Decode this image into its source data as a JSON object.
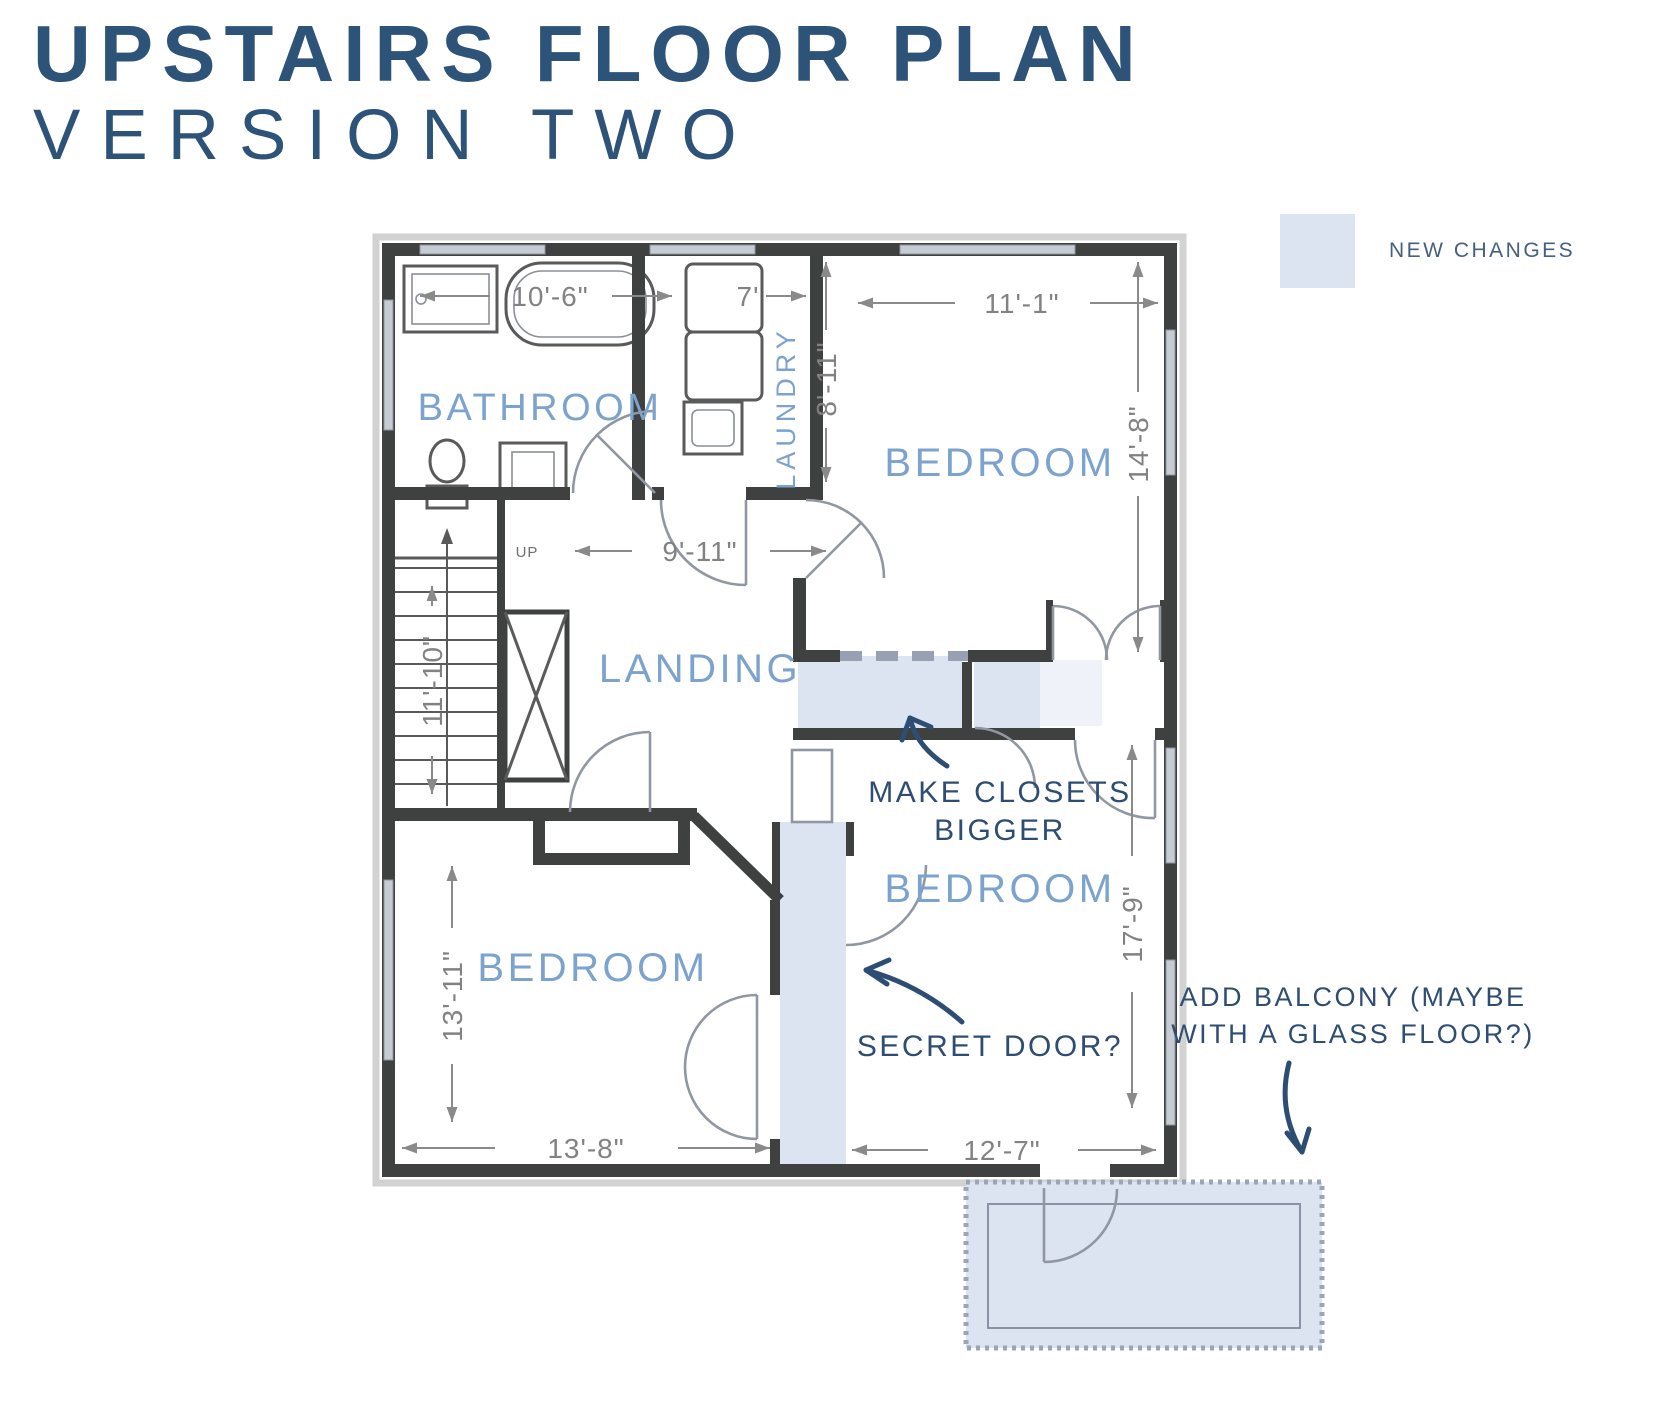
{
  "title": {
    "line1": "UPSTAIRS FLOOR PLAN",
    "line2": "VERSION TWO"
  },
  "legend": {
    "label": "NEW CHANGES",
    "swatch_color": "#dce3f1"
  },
  "rooms": {
    "bathroom": "BATHROOM",
    "laundry": "LAUNDRY",
    "bedroom_top_right": "BEDROOM",
    "landing": "LANDING",
    "bedroom_bottom_left": "BEDROOM",
    "bedroom_bottom_right": "BEDROOM"
  },
  "stairs": {
    "direction_label": "UP"
  },
  "dimensions": {
    "bathroom_width": "10'-6\"",
    "laundry_width": "7'",
    "laundry_depth": "8'-11\"",
    "bedroom_top_right_width": "11'-1\"",
    "bedroom_top_right_depth": "14'-8\"",
    "landing_width": "9'-11\"",
    "stairwell_depth": "11'-10\"",
    "bedroom_bottom_left_depth": "13'-11\"",
    "bedroom_bottom_left_width": "13'-8\"",
    "bedroom_bottom_right_depth": "17'-9\"",
    "bedroom_bottom_right_width": "12'-7\""
  },
  "annotations": {
    "make_closets_line1": "MAKE CLOSETS",
    "make_closets_line2": "BIGGER",
    "secret_door": "SECRET DOOR?",
    "add_balcony_line1": "ADD BALCONY (MAYBE",
    "add_balcony_line2": "WITH A GLASS FLOOR?)"
  },
  "colors": {
    "title_navy": "#2e5378",
    "annotation_navy": "#2e4d73",
    "room_label_blue": "#7ba3cd",
    "highlight_blue": "#dce3f1",
    "wall_dark": "#3f4040",
    "dimension_gray": "#828282"
  }
}
